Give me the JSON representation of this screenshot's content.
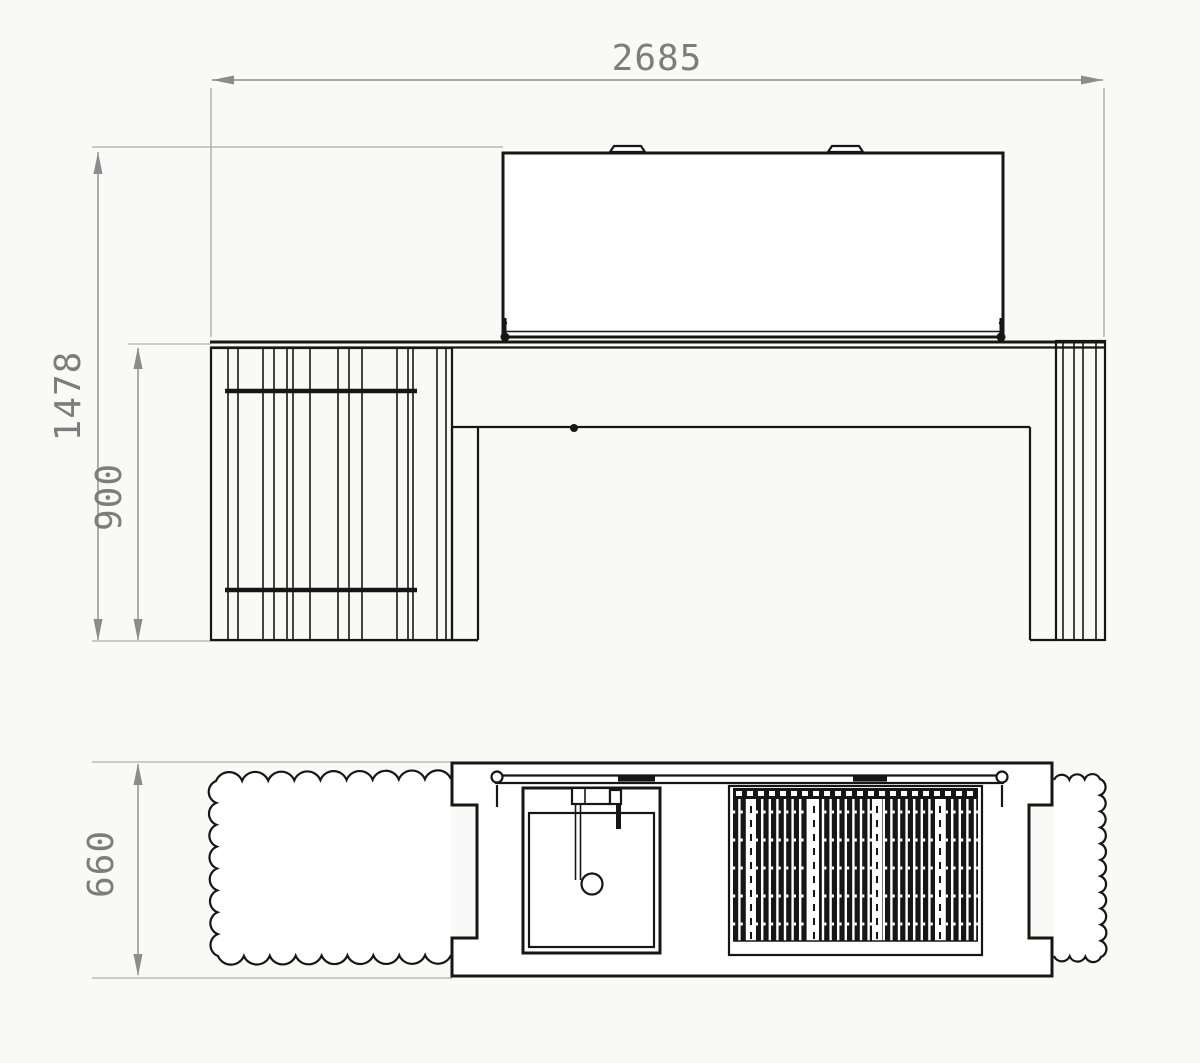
{
  "drawing": {
    "dims": {
      "width": "2685",
      "overall_height": "1478",
      "worktop_height": "900",
      "depth": "660"
    },
    "colors": {
      "object_line": "#161616",
      "dimension_line": "#8c8c8c",
      "dimension_text": "#7d7d7d",
      "background": "#f9f9f8"
    }
  }
}
